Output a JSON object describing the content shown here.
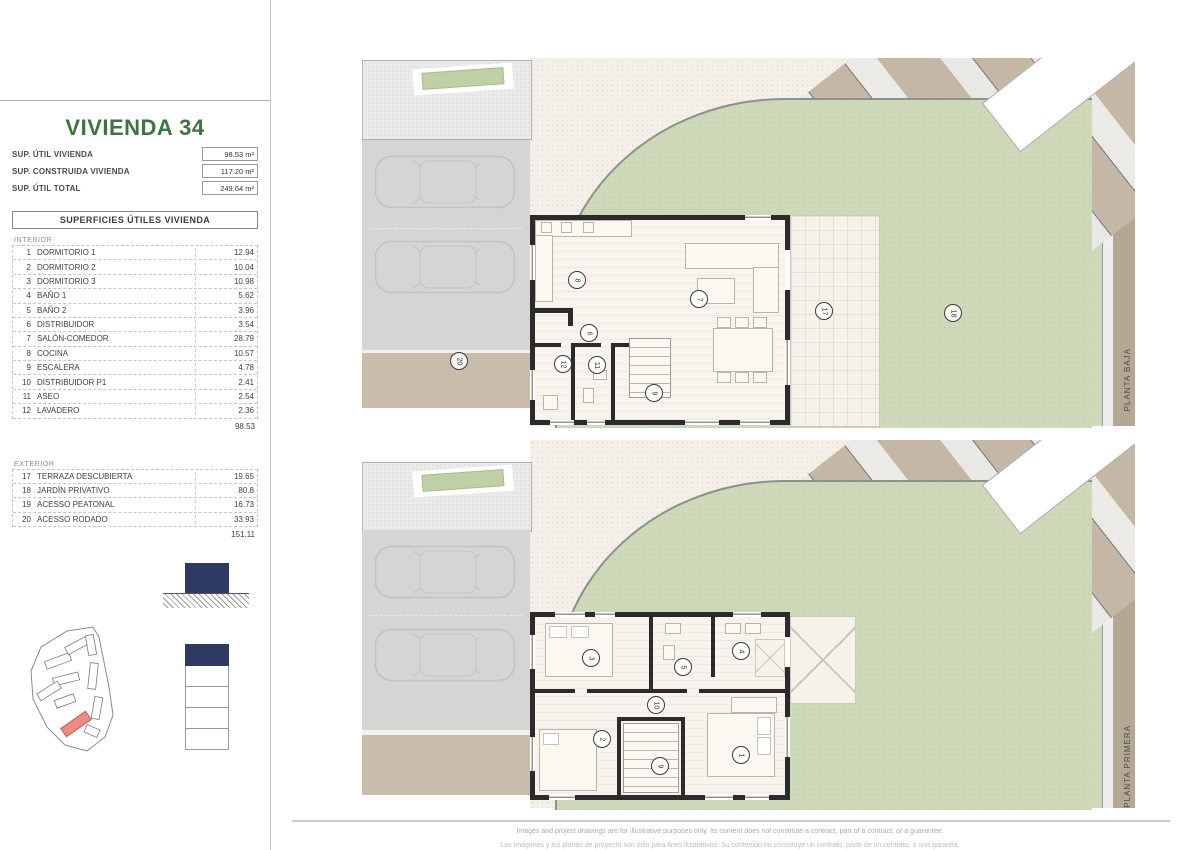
{
  "sidebar": {
    "title": "VIVIENDA 34",
    "summary": [
      {
        "label": "SUP. ÚTIL VIVIENDA",
        "value": "98.53 m²"
      },
      {
        "label": "SUP. CONSTRUIDA VIVIENDA",
        "value": "117.20 m²"
      },
      {
        "label": "SUP. ÚTIL TOTAL",
        "value": "249.64 m²"
      }
    ],
    "table": {
      "header": "SUPERFICIES ÚTILES VIVIENDA",
      "interior_label": "INTERIOR",
      "interior_rows": [
        {
          "num": "1",
          "name": "DORMITORIO 1",
          "area": "12.94"
        },
        {
          "num": "2",
          "name": "DORMITORIO 2",
          "area": "10.04"
        },
        {
          "num": "3",
          "name": "DORMITORIO 3",
          "area": "10.98"
        },
        {
          "num": "4",
          "name": "BAÑO 1",
          "area": "5.62"
        },
        {
          "num": "5",
          "name": "BAÑO 2",
          "area": "3.96"
        },
        {
          "num": "6",
          "name": "DISTRIBUIDOR",
          "area": "3.54"
        },
        {
          "num": "7",
          "name": "SALÓN-COMEDOR",
          "area": "28.79"
        },
        {
          "num": "8",
          "name": "COCINA",
          "area": "10.57"
        },
        {
          "num": "9",
          "name": "ESCALERA",
          "area": "4.78"
        },
        {
          "num": "10",
          "name": "DISTRIBUIDOR P1",
          "area": "2.41"
        },
        {
          "num": "11",
          "name": "ASEO",
          "area": "2.54"
        },
        {
          "num": "12",
          "name": "LAVADERO",
          "area": "2.36"
        }
      ],
      "interior_total": "98.53",
      "exterior_label": "EXTERIOR",
      "exterior_rows": [
        {
          "num": "17",
          "name": "TERRAZA DESCUBIERTA",
          "area": "19.65"
        },
        {
          "num": "18",
          "name": "JARDÍN PRIVATIVO",
          "area": "80.8"
        },
        {
          "num": "19",
          "name": "ACESSO PEATONAL",
          "area": "16.73"
        },
        {
          "num": "20",
          "name": "ACESSO RODADO",
          "area": "33.93"
        }
      ],
      "exterior_total": "151.11"
    }
  },
  "plans": [
    {
      "label": "PLANTA BAJA",
      "rooms": [
        {
          "n": "8",
          "x": 286,
          "y": 221
        },
        {
          "n": "7",
          "x": 408,
          "y": 240
        },
        {
          "n": "6",
          "x": 298,
          "y": 274
        },
        {
          "n": "12",
          "x": 272,
          "y": 305
        },
        {
          "n": "11",
          "x": 306,
          "y": 306
        },
        {
          "n": "9",
          "x": 363,
          "y": 334
        },
        {
          "n": "17",
          "x": 533,
          "y": 252
        },
        {
          "n": "18",
          "x": 662,
          "y": 254
        },
        {
          "n": "20",
          "x": 168,
          "y": 302
        }
      ]
    },
    {
      "label": "PLANTA PRIMERA",
      "rooms": [
        {
          "n": "3",
          "x": 300,
          "y": 217
        },
        {
          "n": "5",
          "x": 392,
          "y": 226
        },
        {
          "n": "4",
          "x": 450,
          "y": 210
        },
        {
          "n": "10",
          "x": 365,
          "y": 264
        },
        {
          "n": "2",
          "x": 311,
          "y": 298
        },
        {
          "n": "9",
          "x": 369,
          "y": 325
        },
        {
          "n": "1",
          "x": 450,
          "y": 314
        }
      ]
    }
  ],
  "footer": {
    "line1": "Images and project drawings are for illustrative purposes only. Its content does not constitute a contract, part of a contract, or a guarantee.",
    "line2": "Las imágenes y los planos de proyecto son solo para fines ilustrativos. Su contenido no constituye un contrato, parte de un contrato, o una garantía."
  },
  "colors": {
    "accent_green": "#3e7342",
    "navy": "#2e3a63",
    "highlight_red": "#ee8b82",
    "garden_green": "#cdd9b8",
    "driveway_tan": "#c9bcab",
    "parking_gray": "#d5d5d3",
    "wall_black": "#2b2b2b"
  }
}
